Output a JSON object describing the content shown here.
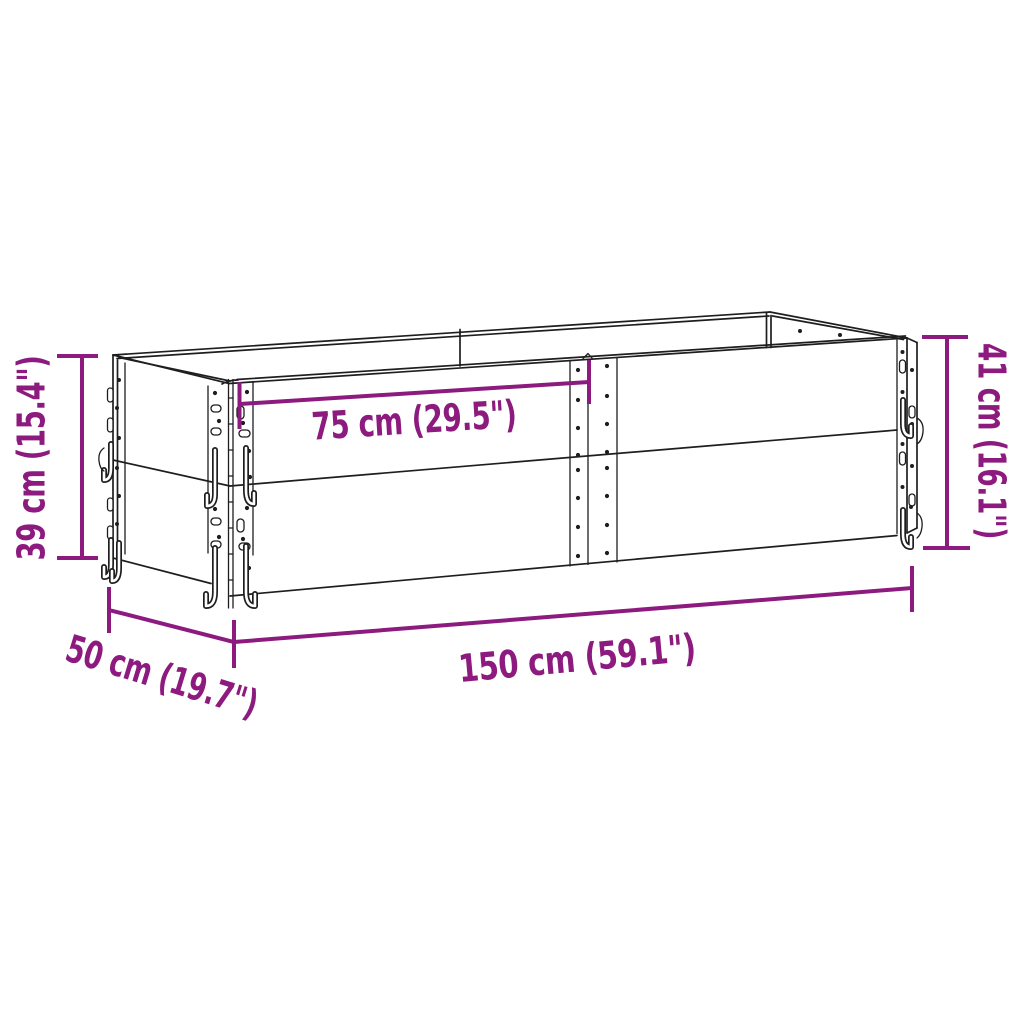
{
  "diagram": {
    "accent_color": "#8d1a7e",
    "line_color": "#1e1e1e",
    "background_color": "#ffffff",
    "dimensions": {
      "height_left": "39 cm (15.4\")",
      "height_right": "41 cm (16.1\")",
      "half_length_top": "75 cm (29.5\")",
      "length_bottom": "150 cm (59.1\")",
      "width_side": "50 cm (19.7\")"
    }
  }
}
